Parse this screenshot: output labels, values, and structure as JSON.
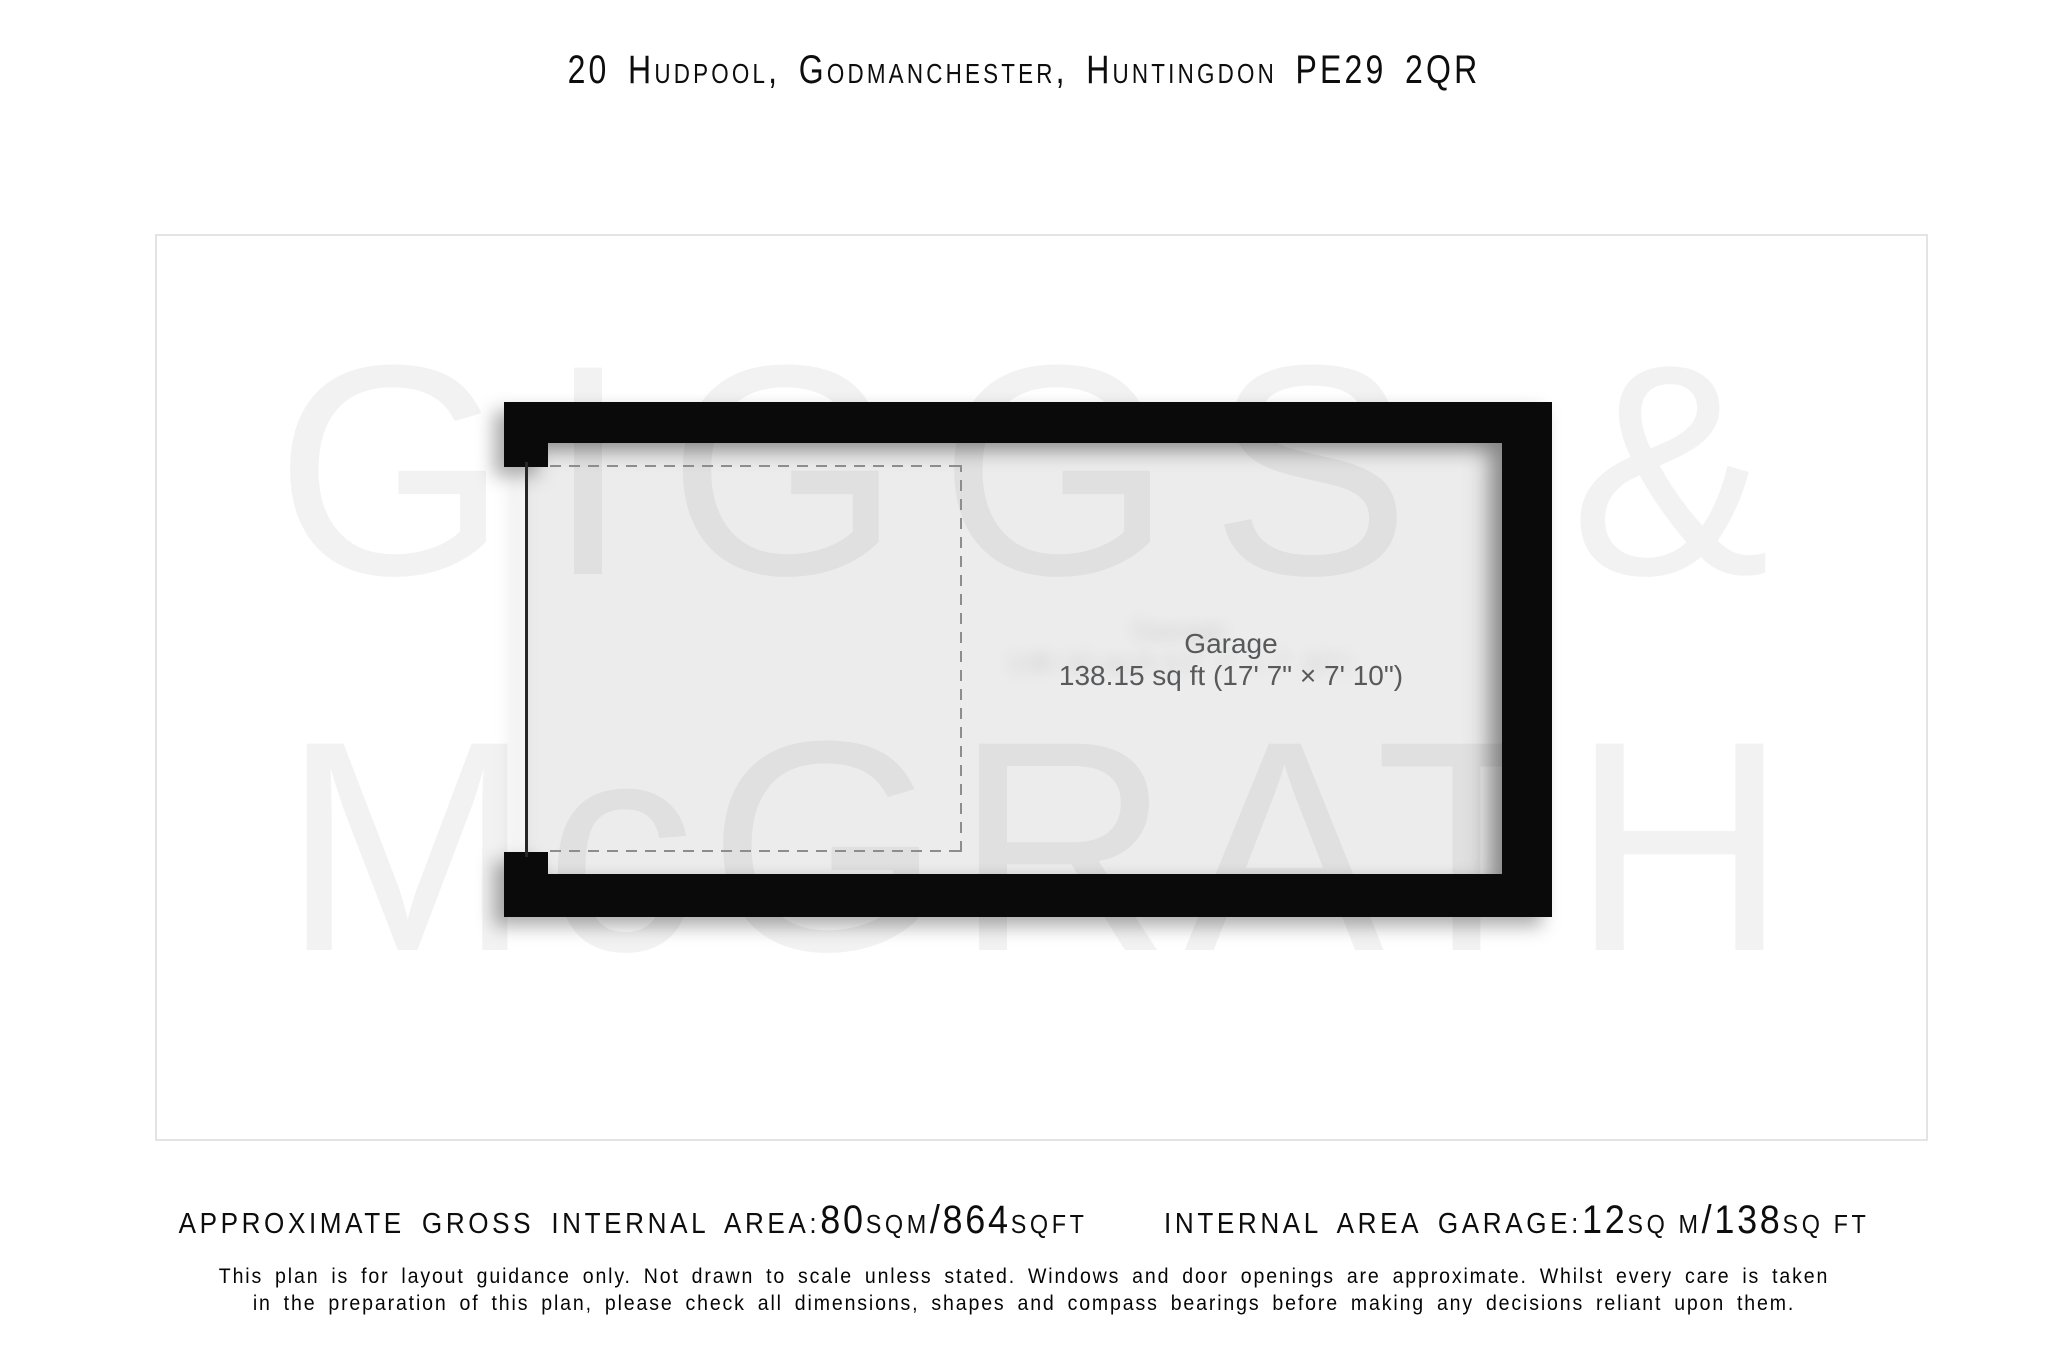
{
  "title": "20 Hudpool, Godmanchester, Huntingdon PE29 2QR",
  "watermark": {
    "line1": "GIGGS &",
    "line2": "McGRATH"
  },
  "floorplan": {
    "room_label": "Garage",
    "room_dimensions": "138.15 sq ft (17' 7\" × 7' 10\")"
  },
  "footer": {
    "area1": {
      "label": "Approximate Gross Internal Area: ",
      "value_sqm": "80",
      "unit_sqm": "sqm",
      "slash": "/",
      "value_sqft": "864",
      "unit_sqft": "sqft"
    },
    "area2": {
      "label": "Internal Area Garage: ",
      "value_sqm": "12",
      "unit_sqm": "sq m",
      "slash": "/",
      "value_sqft": "138",
      "unit_sqft": "sq ft"
    },
    "disclaimer_line1": "This plan is for layout guidance only. Not drawn to scale unless stated. Windows and door openings are approximate. Whilst every care is taken",
    "disclaimer_line2": "in the preparation of this plan, please check all dimensions, shapes and compass bearings before making any decisions reliant upon them."
  },
  "colors": {
    "wall": "#0a0a0a",
    "interior": "#ececec",
    "dashed": "#8d8d8d",
    "frame-border": "#e4e4e4",
    "label-text": "#58595b",
    "watermark": "rgba(0,0,0,0.05)"
  }
}
